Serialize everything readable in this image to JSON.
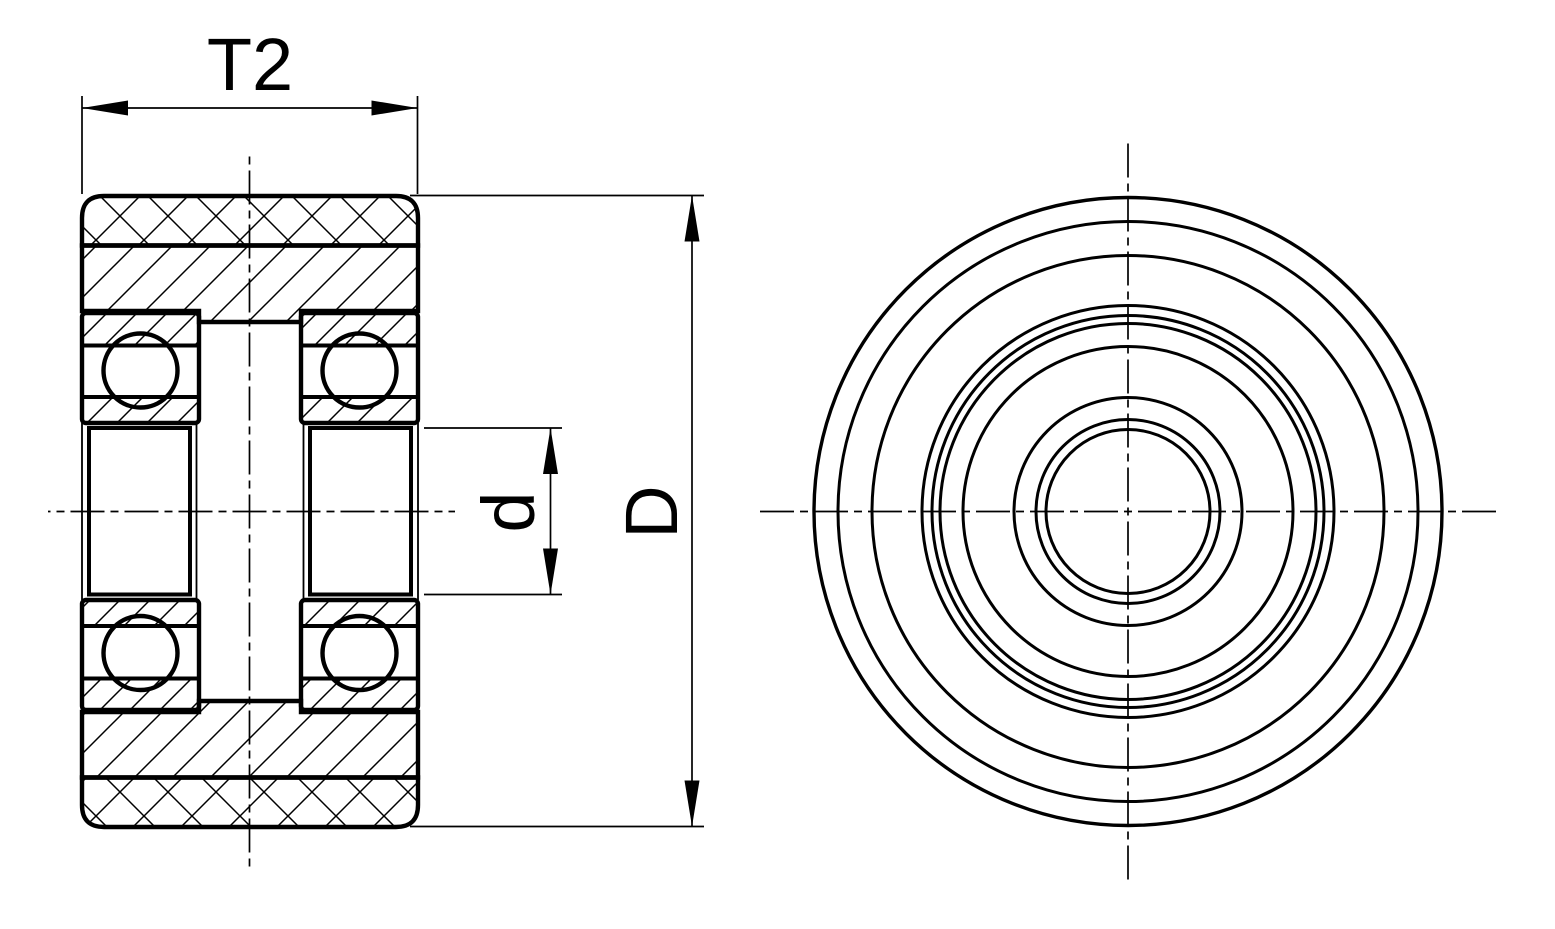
{
  "labels": {
    "width_dimension": "T2",
    "bore_diameter_dimension": "d",
    "outer_diameter_dimension": "D"
  },
  "colors": {
    "line": "#000000",
    "background": "#ffffff"
  },
  "drawing": {
    "description_left_view": "sectioned roller with two ball bearings",
    "description_right_view": "front view concentric circles"
  }
}
